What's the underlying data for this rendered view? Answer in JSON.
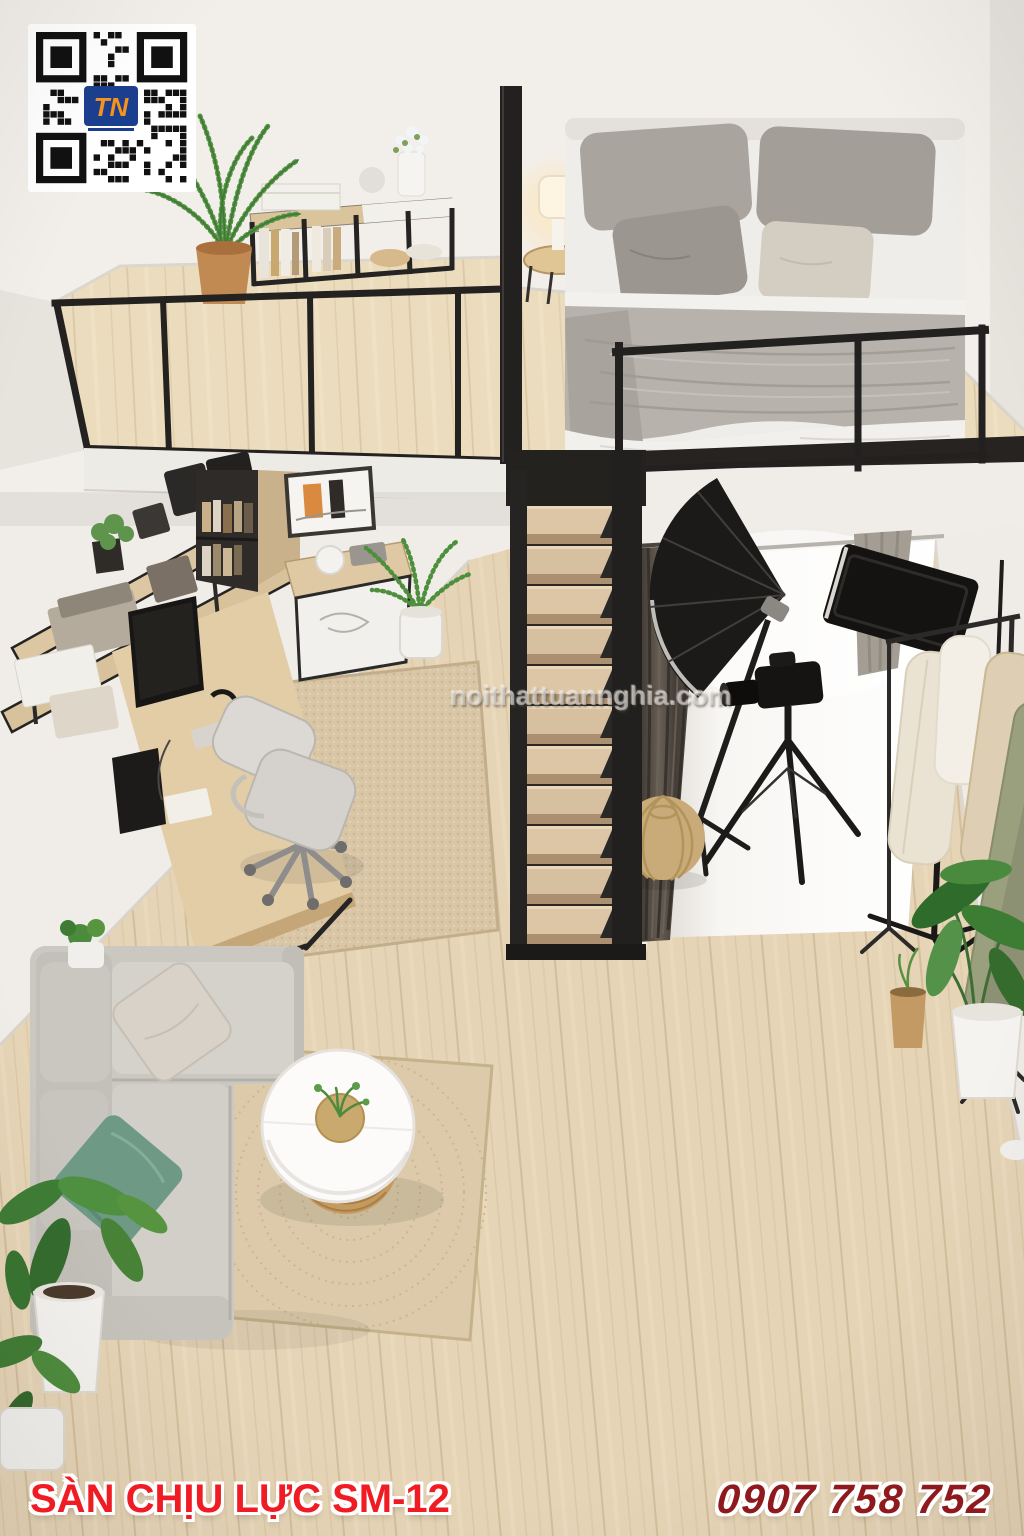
{
  "qr": {
    "logo_text": "TN"
  },
  "watermark": {
    "text": "noithattuannghia.com"
  },
  "footer": {
    "product_label": "SÀN CHỊU LỰC SM-12",
    "phone": "0907 758 752"
  },
  "colors": {
    "product_label_red": "#ef1d23",
    "phone_dark_red": "#8f1a1e",
    "wall_white": "#f2efeb",
    "wood_floor": "#e6d4b6",
    "metal_black": "#262422",
    "sofa_gray": "#cccac4",
    "pillow_green": "#6e9a85",
    "rug_beige": "#d8c6a6",
    "qr_logo_blue": "#1b3f8f",
    "qr_logo_orange": "#f7941d"
  }
}
